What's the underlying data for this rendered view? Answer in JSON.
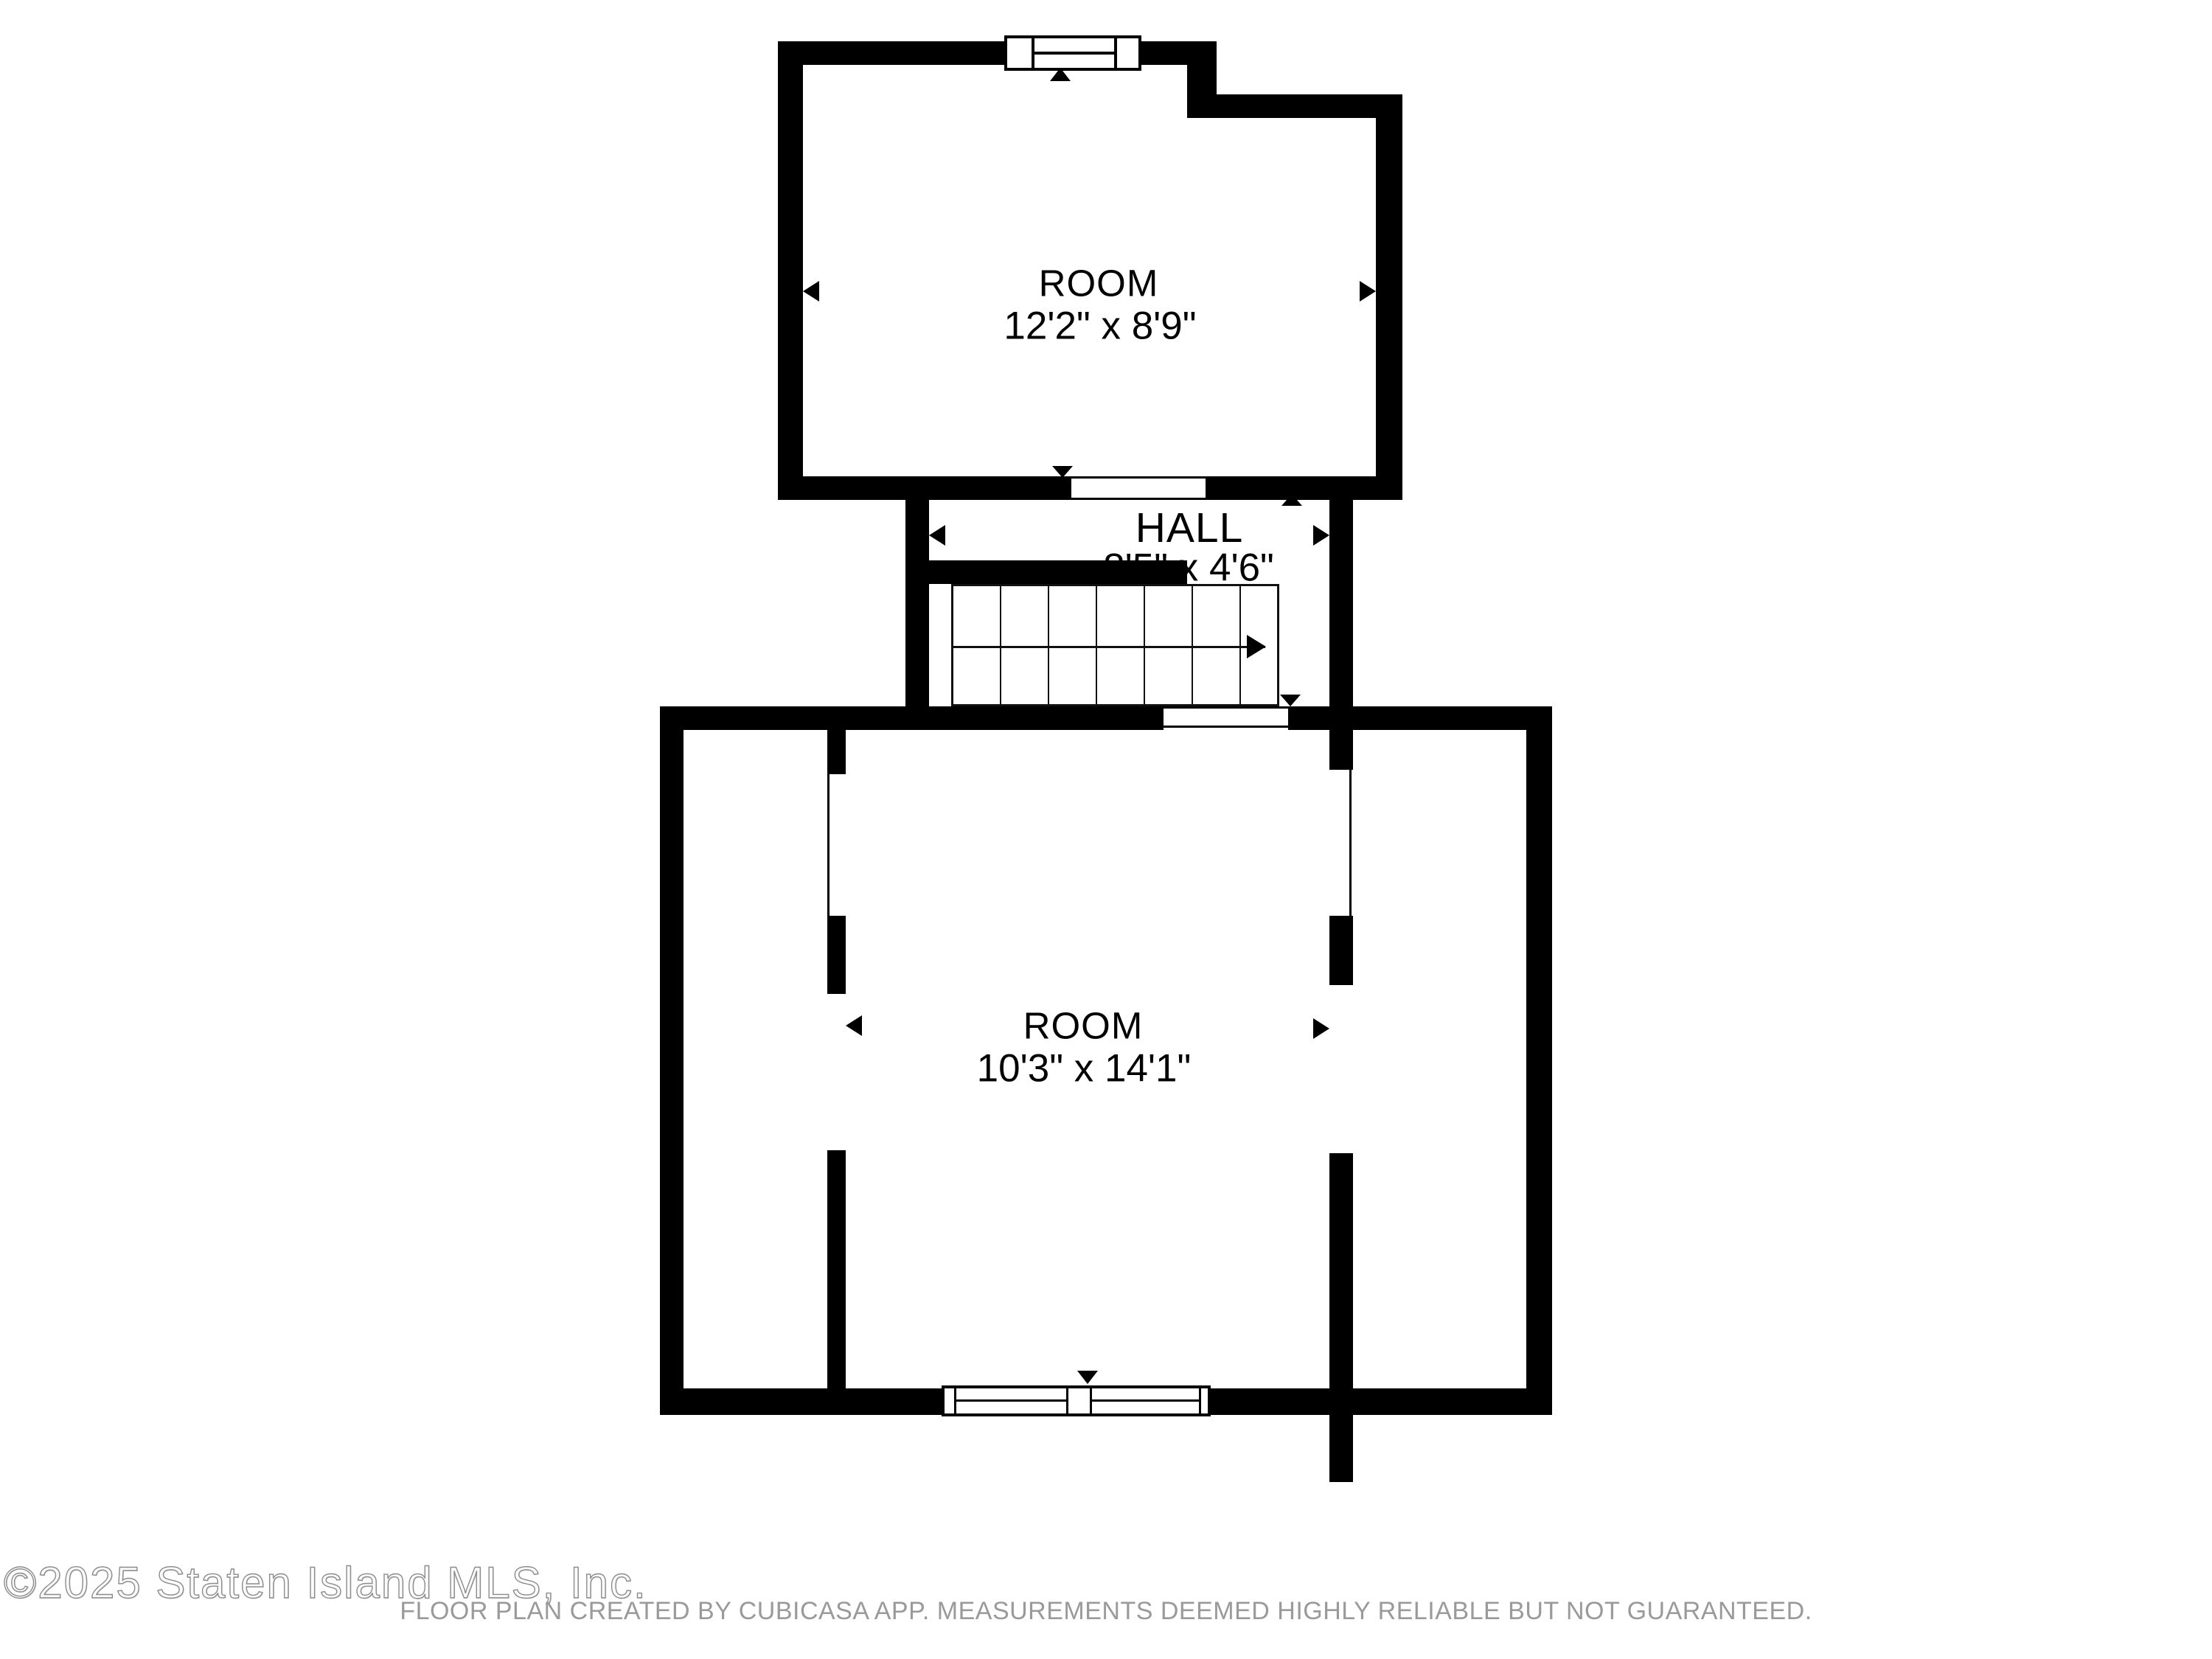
{
  "colors": {
    "wall": "#000000",
    "background": "#ffffff",
    "disclaimer_text": "#9a9a9a",
    "watermark_outline": "#8c8c8c"
  },
  "rooms": {
    "top_room": {
      "name": "ROOM",
      "dimensions": "12'2\" x 8'9\""
    },
    "hall": {
      "name": "HALL",
      "dimensions": "8'5\" x 4'6\""
    },
    "bottom_room": {
      "name": "ROOM",
      "dimensions": "10'3\" x 14'1\""
    }
  },
  "icons": {
    "stairs": "staircase-with-up-arrow",
    "window_top": "double-pane-window",
    "window_bottom": "double-window",
    "door_markers": "entry-direction-triangles",
    "dimension_markers": "wall-measurement-arrows"
  },
  "footer": {
    "watermark": "©2025 Staten Island MLS, Inc.",
    "disclaimer": "FLOOR PLAN CREATED BY CUBICASA APP. MEASUREMENTS DEEMED HIGHLY RELIABLE BUT NOT GUARANTEED."
  }
}
